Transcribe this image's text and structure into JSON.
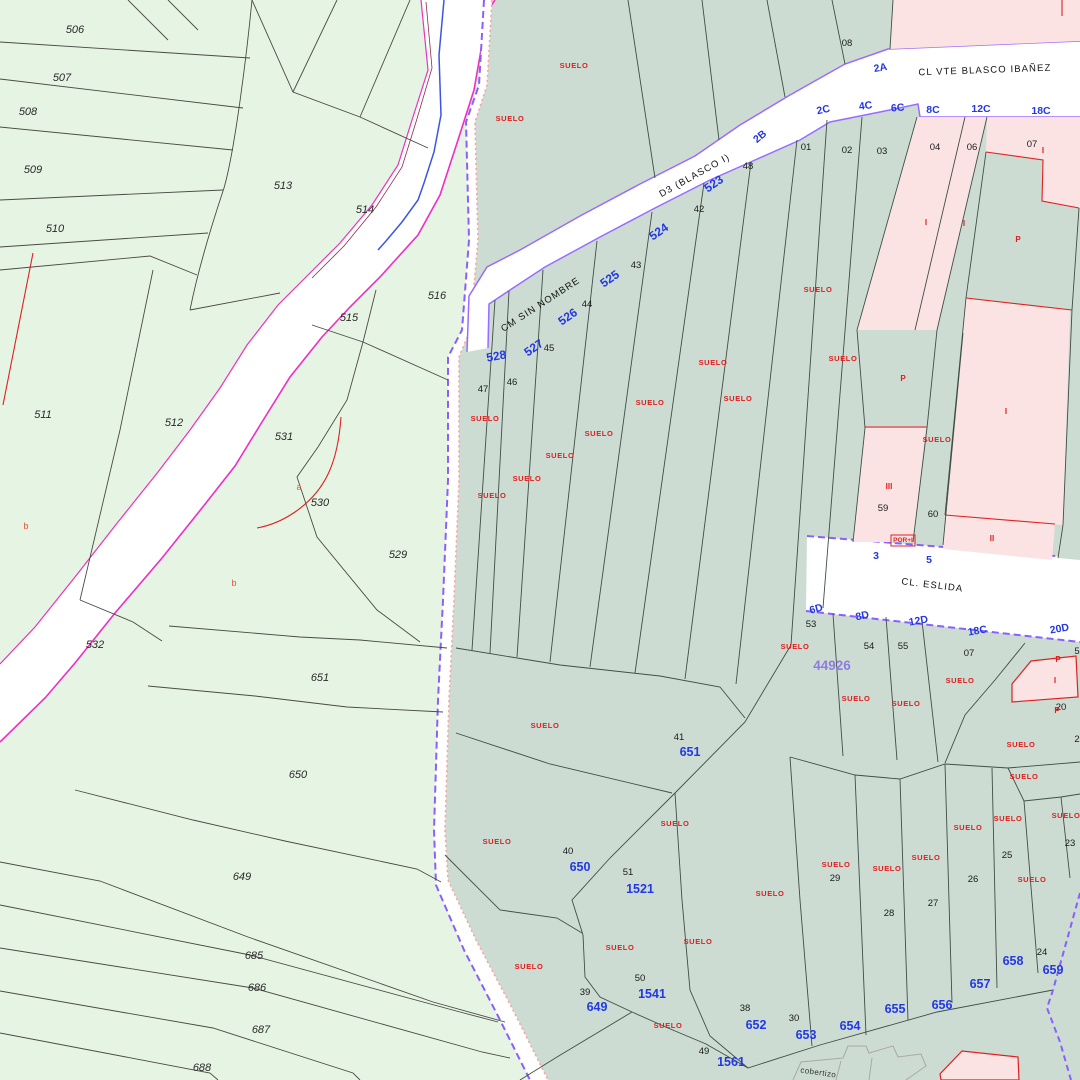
{
  "map": {
    "colors": {
      "rural_zone": "#e6f4e4",
      "urban_zone": "#ccdcd2",
      "building": "#fbe3e3",
      "road": "#ffffff",
      "boundary_purple": "#8a5fff",
      "boundary_pink": "#ff9f9f",
      "river_magenta": "#ee2fc4",
      "stream_blue": "#3b55e6",
      "label_red": "#e21d1d",
      "label_blue": "#2337e4",
      "label_violet": "#8f7ce0"
    },
    "streets": [
      {
        "t": "CL VTE BLASCO IBAÑEZ",
        "x": 985,
        "y": 73,
        "r": -2
      },
      {
        "t": "CM SIN NOMBRE",
        "x": 542,
        "y": 307,
        "r": -33
      },
      {
        "t": "D3 (BLASCO I)",
        "x": 696,
        "y": 178,
        "r": -29
      },
      {
        "t": "CL. ESLIDA",
        "x": 932,
        "y": 588,
        "r": 7
      },
      {
        "t": "cobertizo",
        "x": 818,
        "y": 1075,
        "r": 8
      }
    ],
    "left_parcels": [
      {
        "t": "506",
        "x": 75,
        "y": 33
      },
      {
        "t": "507",
        "x": 62,
        "y": 81
      },
      {
        "t": "508",
        "x": 28,
        "y": 115
      },
      {
        "t": "509",
        "x": 33,
        "y": 173
      },
      {
        "t": "510",
        "x": 55,
        "y": 232
      },
      {
        "t": "511",
        "x": 43,
        "y": 418
      },
      {
        "t": "512",
        "x": 174,
        "y": 426
      },
      {
        "t": "513",
        "x": 283,
        "y": 189
      },
      {
        "t": "514",
        "x": 365,
        "y": 213
      },
      {
        "t": "515",
        "x": 349,
        "y": 321
      },
      {
        "t": "516",
        "x": 437,
        "y": 299
      },
      {
        "t": "529",
        "x": 398,
        "y": 558
      },
      {
        "t": "530",
        "x": 320,
        "y": 506
      },
      {
        "t": "531",
        "x": 284,
        "y": 440
      },
      {
        "t": "532",
        "x": 95,
        "y": 648
      },
      {
        "t": "649",
        "x": 242,
        "y": 880
      },
      {
        "t": "650",
        "x": 298,
        "y": 778
      },
      {
        "t": "651",
        "x": 320,
        "y": 681
      },
      {
        "t": "685",
        "x": 254,
        "y": 959
      },
      {
        "t": "686",
        "x": 257,
        "y": 991
      },
      {
        "t": "687",
        "x": 261,
        "y": 1033
      },
      {
        "t": "688",
        "x": 202,
        "y": 1071
      }
    ],
    "lot_numbers": [
      {
        "t": "08",
        "x": 847,
        "y": 46
      },
      {
        "t": "01",
        "x": 806,
        "y": 150
      },
      {
        "t": "02",
        "x": 847,
        "y": 153
      },
      {
        "t": "03",
        "x": 882,
        "y": 154
      },
      {
        "t": "04",
        "x": 935,
        "y": 150
      },
      {
        "t": "06",
        "x": 972,
        "y": 150
      },
      {
        "t": "07",
        "x": 1032,
        "y": 147
      },
      {
        "t": "48",
        "x": 748,
        "y": 169
      },
      {
        "t": "42",
        "x": 699,
        "y": 212
      },
      {
        "t": "43",
        "x": 636,
        "y": 268
      },
      {
        "t": "44",
        "x": 587,
        "y": 307
      },
      {
        "t": "45",
        "x": 549,
        "y": 351
      },
      {
        "t": "46",
        "x": 512,
        "y": 385
      },
      {
        "t": "47",
        "x": 483,
        "y": 392
      },
      {
        "t": "59",
        "x": 883,
        "y": 511
      },
      {
        "t": "60",
        "x": 933,
        "y": 517
      },
      {
        "t": "53",
        "x": 811,
        "y": 627
      },
      {
        "t": "54",
        "x": 869,
        "y": 649
      },
      {
        "t": "55",
        "x": 903,
        "y": 649
      },
      {
        "t": "07",
        "x": 969,
        "y": 656
      },
      {
        "t": "20",
        "x": 1061,
        "y": 710
      },
      {
        "t": "41",
        "x": 679,
        "y": 740
      },
      {
        "t": "40",
        "x": 568,
        "y": 854
      },
      {
        "t": "51",
        "x": 628,
        "y": 875
      },
      {
        "t": "39",
        "x": 585,
        "y": 995
      },
      {
        "t": "50",
        "x": 640,
        "y": 981
      },
      {
        "t": "38",
        "x": 745,
        "y": 1011
      },
      {
        "t": "30",
        "x": 794,
        "y": 1021
      },
      {
        "t": "49",
        "x": 704,
        "y": 1054
      },
      {
        "t": "29",
        "x": 835,
        "y": 881
      },
      {
        "t": "28",
        "x": 889,
        "y": 916
      },
      {
        "t": "27",
        "x": 933,
        "y": 906
      },
      {
        "t": "26",
        "x": 973,
        "y": 882
      },
      {
        "t": "25",
        "x": 1007,
        "y": 858
      },
      {
        "t": "24",
        "x": 1042,
        "y": 955
      },
      {
        "t": "23",
        "x": 1070,
        "y": 846
      },
      {
        "t": "5",
        "x": 1077,
        "y": 654
      },
      {
        "t": "2",
        "x": 1077,
        "y": 742
      }
    ],
    "suelo_text": "SUELO",
    "suelo_labels": [
      {
        "x": 574,
        "y": 68
      },
      {
        "x": 510,
        "y": 121
      },
      {
        "x": 485,
        "y": 421
      },
      {
        "x": 492,
        "y": 498
      },
      {
        "x": 527,
        "y": 481
      },
      {
        "x": 560,
        "y": 458
      },
      {
        "x": 599,
        "y": 436
      },
      {
        "x": 650,
        "y": 405
      },
      {
        "x": 713,
        "y": 365
      },
      {
        "x": 738,
        "y": 401
      },
      {
        "x": 818,
        "y": 292
      },
      {
        "x": 843,
        "y": 361
      },
      {
        "x": 937,
        "y": 442
      },
      {
        "x": 795,
        "y": 649
      },
      {
        "x": 960,
        "y": 683
      },
      {
        "x": 856,
        "y": 701
      },
      {
        "x": 906,
        "y": 706
      },
      {
        "x": 1021,
        "y": 747
      },
      {
        "x": 1024,
        "y": 779
      },
      {
        "x": 545,
        "y": 728
      },
      {
        "x": 675,
        "y": 826
      },
      {
        "x": 497,
        "y": 844
      },
      {
        "x": 529,
        "y": 969
      },
      {
        "x": 620,
        "y": 950
      },
      {
        "x": 698,
        "y": 944
      },
      {
        "x": 668,
        "y": 1028
      },
      {
        "x": 770,
        "y": 896
      },
      {
        "x": 836,
        "y": 867
      },
      {
        "x": 887,
        "y": 871
      },
      {
        "x": 926,
        "y": 860
      },
      {
        "x": 968,
        "y": 830
      },
      {
        "x": 1008,
        "y": 821
      },
      {
        "x": 1066,
        "y": 818
      },
      {
        "x": 1032,
        "y": 882
      }
    ],
    "blue_area_numbers": [
      {
        "t": "649",
        "x": 597,
        "y": 1011
      },
      {
        "t": "650",
        "x": 580,
        "y": 871
      },
      {
        "t": "651",
        "x": 690,
        "y": 756
      },
      {
        "t": "652",
        "x": 756,
        "y": 1029
      },
      {
        "t": "653",
        "x": 806,
        "y": 1039
      },
      {
        "t": "654",
        "x": 850,
        "y": 1030
      },
      {
        "t": "655",
        "x": 895,
        "y": 1013
      },
      {
        "t": "656",
        "x": 942,
        "y": 1009
      },
      {
        "t": "657",
        "x": 980,
        "y": 988
      },
      {
        "t": "658",
        "x": 1013,
        "y": 965
      },
      {
        "t": "659",
        "x": 1053,
        "y": 974
      },
      {
        "t": "1521",
        "x": 640,
        "y": 893
      },
      {
        "t": "1541",
        "x": 652,
        "y": 998
      },
      {
        "t": "1561",
        "x": 731,
        "y": 1066
      }
    ],
    "blue_road_codes": [
      {
        "t": "523",
        "x": 716,
        "y": 187,
        "r": -35
      },
      {
        "t": "524",
        "x": 661,
        "y": 235,
        "r": -35
      },
      {
        "t": "525",
        "x": 612,
        "y": 282,
        "r": -35
      },
      {
        "t": "526",
        "x": 570,
        "y": 320,
        "r": -35
      },
      {
        "t": "527",
        "x": 536,
        "y": 351,
        "r": -35
      },
      {
        "t": "528",
        "x": 497,
        "y": 360,
        "r": -10
      }
    ],
    "portal_numbers": [
      {
        "t": "2A",
        "x": 881,
        "y": 71,
        "r": -10
      },
      {
        "t": "2B",
        "x": 762,
        "y": 139,
        "r": -40
      },
      {
        "t": "2C",
        "x": 824,
        "y": 113,
        "r": -12
      },
      {
        "t": "4C",
        "x": 866,
        "y": 109,
        "r": -8
      },
      {
        "t": "6C",
        "x": 898,
        "y": 111,
        "r": -5
      },
      {
        "t": "8C",
        "x": 933,
        "y": 113,
        "r": 0
      },
      {
        "t": "12C",
        "x": 981,
        "y": 112,
        "r": 0
      },
      {
        "t": "18C",
        "x": 1041,
        "y": 114,
        "r": 0
      },
      {
        "t": "6D",
        "x": 817,
        "y": 612,
        "r": -15
      },
      {
        "t": "8D",
        "x": 863,
        "y": 619,
        "r": -12
      },
      {
        "t": "12D",
        "x": 919,
        "y": 624,
        "r": -10
      },
      {
        "t": "18C",
        "x": 978,
        "y": 634,
        "r": -10
      },
      {
        "t": "20D",
        "x": 1060,
        "y": 632,
        "r": -10
      },
      {
        "t": "3",
        "x": 876,
        "y": 559,
        "r": 0
      },
      {
        "t": "5",
        "x": 929,
        "y": 563,
        "r": 0
      }
    ],
    "construction_marks": [
      {
        "t": "I",
        "x": 926,
        "y": 225
      },
      {
        "t": "I",
        "x": 964,
        "y": 226
      },
      {
        "t": "I",
        "x": 1043,
        "y": 153
      },
      {
        "t": "P",
        "x": 1018,
        "y": 242
      },
      {
        "t": "P",
        "x": 903,
        "y": 381
      },
      {
        "t": "III",
        "x": 889,
        "y": 489
      },
      {
        "t": "I",
        "x": 1006,
        "y": 414
      },
      {
        "t": "II",
        "x": 992,
        "y": 541
      },
      {
        "t": "I",
        "x": 1055,
        "y": 683
      },
      {
        "t": "P",
        "x": 1058,
        "y": 662
      },
      {
        "t": "P",
        "x": 1057,
        "y": 713
      }
    ],
    "red_letters": [
      {
        "t": "a",
        "x": 299,
        "y": 490
      },
      {
        "t": "b",
        "x": 26,
        "y": 529
      },
      {
        "t": "b",
        "x": 234,
        "y": 586
      }
    ],
    "admin_code": {
      "t": "44926",
      "x": 832,
      "y": 670
    },
    "por_label": {
      "t": "POR+I",
      "x": 903,
      "y": 542
    }
  }
}
